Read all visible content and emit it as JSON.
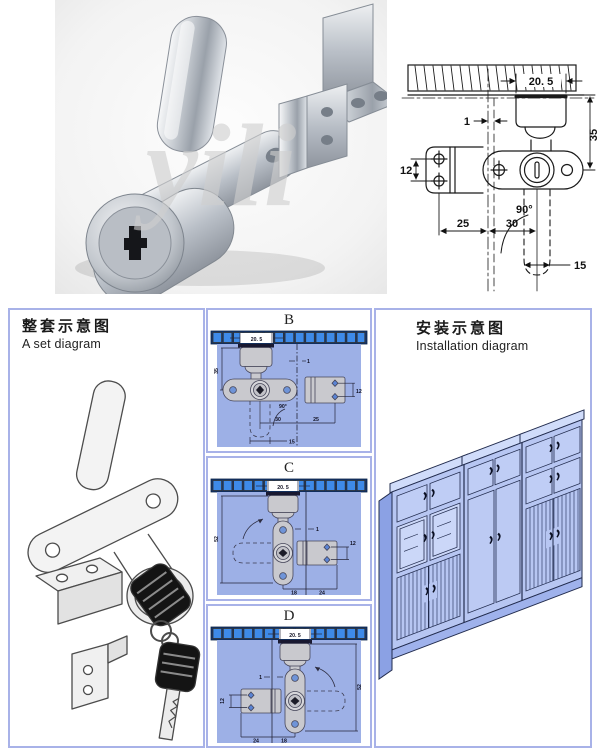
{
  "colors": {
    "panel_border": "#a8b2e8",
    "diagram_bg": "#9db0e6",
    "strip_cell": "#3e8ae8",
    "strip_dark": "#16366b",
    "cabinet_front": "#b7c6f2",
    "cabinet_side": "#8ba1e4",
    "cabinet_slab": "#d0dcfa",
    "line_dark": "#1a1a1a"
  },
  "photo": {
    "watermark": "yili"
  },
  "main_drawing": {
    "dims": {
      "w": "20. 5",
      "off": "1",
      "h": "35",
      "br": "12",
      "ang": "90°",
      "a": "25",
      "b": "30",
      "cam": "15"
    }
  },
  "set_panel": {
    "title_zh": "整套示意图",
    "title_en": "A set diagram"
  },
  "view_b": {
    "label": "B",
    "dims": {
      "w": "20. 5",
      "h": "35",
      "off": "1",
      "br": "12",
      "ang": "90°",
      "b": "30",
      "a": "25",
      "cam": "15"
    }
  },
  "view_c": {
    "label": "C",
    "dims": {
      "w": "20. 5",
      "h": "52",
      "off": "1",
      "br": "12",
      "a": "18",
      "b": "24"
    }
  },
  "view_d": {
    "label": "D",
    "dims": {
      "w": "20. 5",
      "h": "52",
      "off": "1",
      "br": "12",
      "a": "18",
      "b": "24"
    }
  },
  "install_panel": {
    "title_zh": "安装示意图",
    "title_en": "Installation diagram"
  }
}
